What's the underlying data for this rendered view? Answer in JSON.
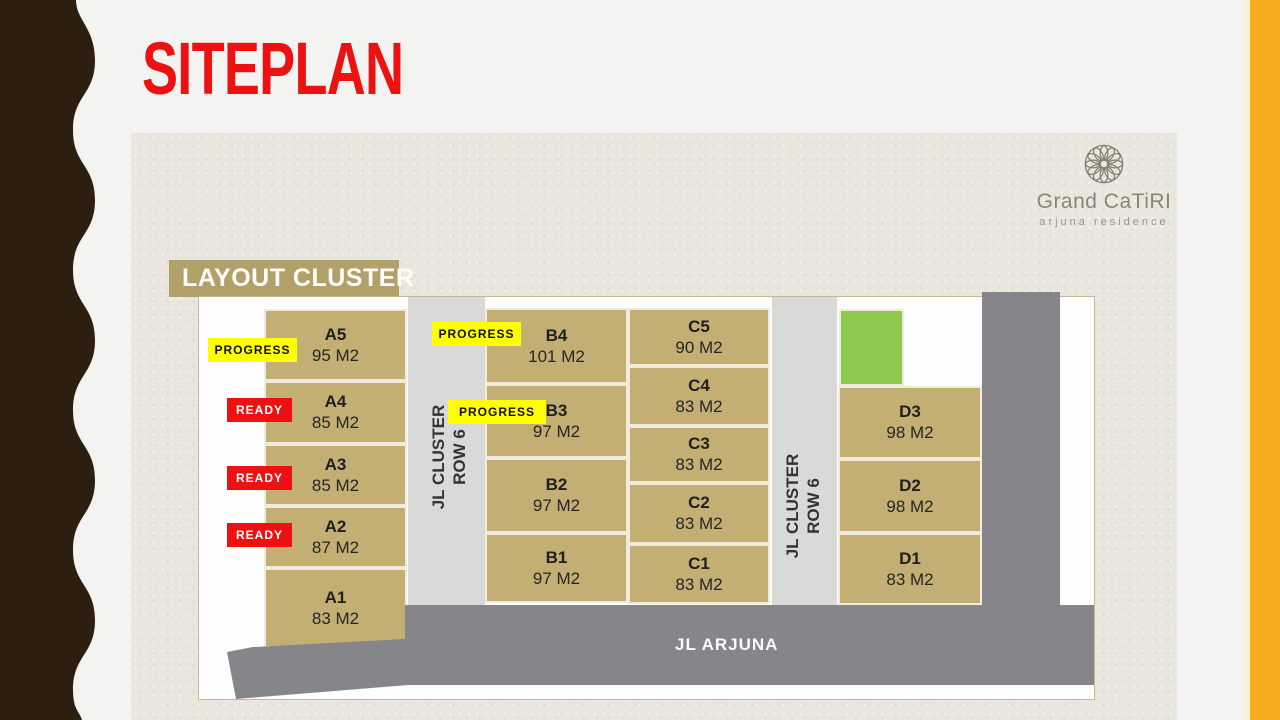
{
  "slide": {
    "title": "SITEPLAN"
  },
  "logo": {
    "icon": "rosette-icon",
    "brand": "Grand CaTiRI",
    "tagline": "arjuna residence"
  },
  "plan": {
    "section_label": "LAYOUT CLUSTER",
    "roads": {
      "left_vertical": {
        "line1": "JL CLUSTER",
        "line2": "ROW 6"
      },
      "right_vertical": {
        "line1": "JL CLUSTER",
        "line2": "ROW 6"
      },
      "bottom": {
        "label": "JL ARJUNA"
      }
    },
    "badges": [
      {
        "label": "PROGRESS",
        "type": "progress",
        "unit": "A5"
      },
      {
        "label": "READY",
        "type": "ready",
        "unit": "A4"
      },
      {
        "label": "READY",
        "type": "ready",
        "unit": "A3"
      },
      {
        "label": "READY",
        "type": "ready",
        "unit": "A2"
      },
      {
        "label": "PROGRESS",
        "type": "progress",
        "unit": "B4"
      },
      {
        "label": "PROGRESS",
        "type": "progress",
        "unit": "B3"
      }
    ],
    "columns": {
      "a": [
        {
          "id": "A5",
          "area": "95 M2"
        },
        {
          "id": "A4",
          "area": "85 M2"
        },
        {
          "id": "A3",
          "area": "85 M2"
        },
        {
          "id": "A2",
          "area": "87 M2"
        },
        {
          "id": "A1",
          "area": "83 M2"
        }
      ],
      "b": [
        {
          "id": "B4",
          "area": "101 M2"
        },
        {
          "id": "B3",
          "area": "97 M2"
        },
        {
          "id": "B2",
          "area": "97 M2"
        },
        {
          "id": "B1",
          "area": "97 M2"
        }
      ],
      "c": [
        {
          "id": "C5",
          "area": "90 M2"
        },
        {
          "id": "C4",
          "area": "83 M2"
        },
        {
          "id": "C3",
          "area": "83 M2"
        },
        {
          "id": "C2",
          "area": "83 M2"
        },
        {
          "id": "C1",
          "area": "83 M2"
        }
      ],
      "d": [
        {
          "id": "D3",
          "area": "98 M2"
        },
        {
          "id": "D2",
          "area": "98 M2"
        },
        {
          "id": "D1",
          "area": "83 M2"
        }
      ]
    },
    "green_block": "green-area"
  },
  "colors": {
    "accent_red": "#ee1111",
    "badge_yellow": "#ffff00",
    "badge_red": "#ee1111",
    "block_tan": "#c3ae73",
    "banner_tan": "#b1a068",
    "road_dark": "#86868a",
    "road_light": "#d9d9d8",
    "green": "#8ec94e",
    "sidebar_brown": "#2d1f10",
    "edge_orange": "#f6ac1d",
    "panel_beige": "#e9e6de"
  }
}
